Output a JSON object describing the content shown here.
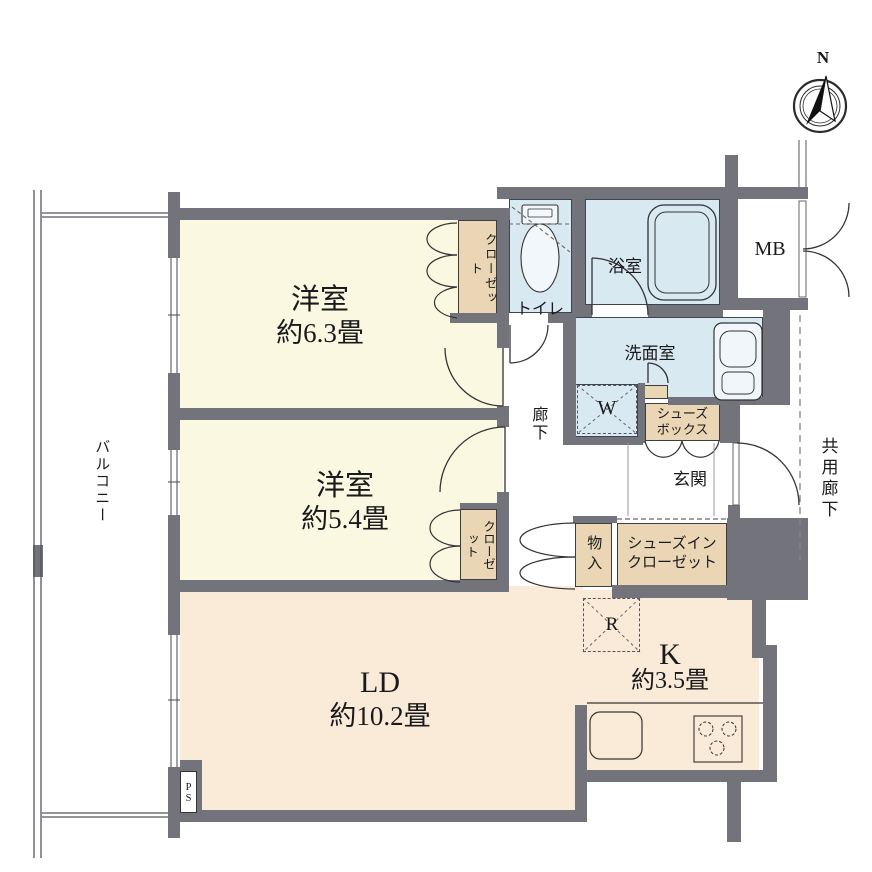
{
  "title": "apartment-floor-plan",
  "compass": {
    "north_label": "N"
  },
  "rooms": {
    "bedroom1": {
      "name": "洋室",
      "size": "約6.3畳"
    },
    "bedroom2": {
      "name": "洋室",
      "size": "約5.4畳"
    },
    "living": {
      "name": "LD",
      "size": "約10.2畳"
    },
    "kitchen": {
      "name": "K",
      "size": "約3.5畳"
    },
    "bath": {
      "name": "浴室"
    },
    "washroom": {
      "name": "洗面室"
    },
    "toilet": {
      "name": "トイレ"
    },
    "entrance": {
      "name": "玄関"
    },
    "hallway": {
      "name": "廊下"
    },
    "balcony": {
      "name": "バルコニー"
    },
    "common_corridor": {
      "name": "共用廊下"
    }
  },
  "storage": {
    "closet1": "クローゼット",
    "closet2": "クローゼット",
    "storage_box": "物入",
    "shoes_box": "シューズ\nボックス",
    "shoes_in_closet": "シューズイン\nクローゼット",
    "meter_box": "MB",
    "pipe_space": "PS",
    "washer_space": "W",
    "fridge_space": "R"
  },
  "colors": {
    "wall": "#73737B",
    "bedroom_floor": "#FBF8E2",
    "living_floor": "#FAEBD9",
    "wet_area_floor": "#D9E9F2",
    "closet_fill": "#EAD6B4",
    "line": "#333333",
    "background": "#FFFFFF"
  }
}
